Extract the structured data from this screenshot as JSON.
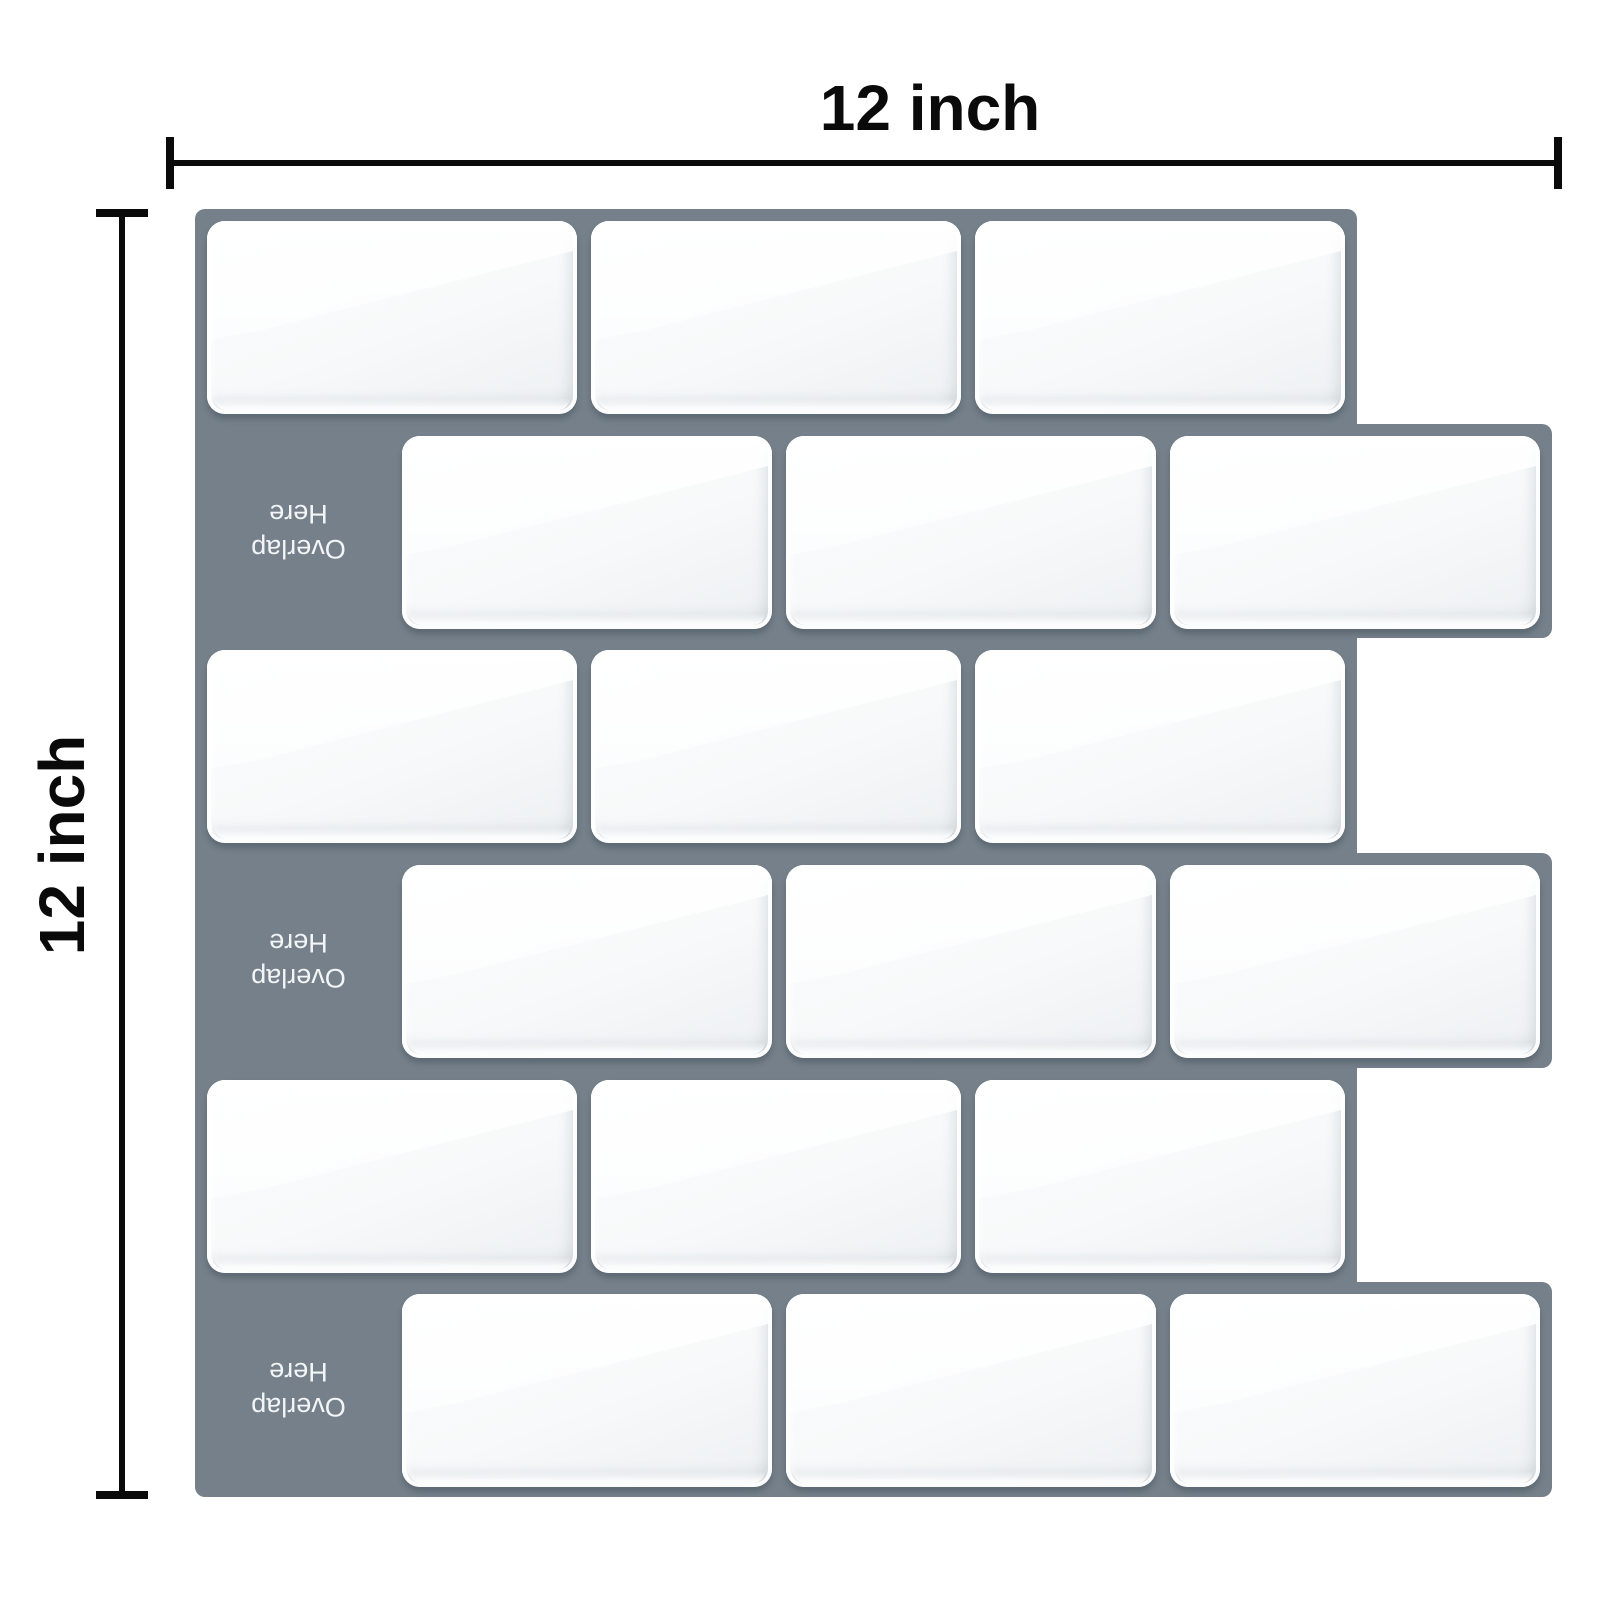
{
  "diagram": {
    "width_label": "12 inch",
    "height_label": "12 inch"
  },
  "panel": {
    "description": "peel-and-stick subway tile sheet",
    "grout_color": "#75808A",
    "tile_color": "#F7F9FA",
    "dimension_line_color": "#0A0A0A",
    "rows": 6,
    "tiles_per_full_row": 3,
    "overlap_labels": [
      {
        "line1": "Overlap",
        "line2": "Here"
      },
      {
        "line1": "Overlap",
        "line2": "Here"
      },
      {
        "line1": "Overlap",
        "line2": "Here"
      }
    ]
  }
}
